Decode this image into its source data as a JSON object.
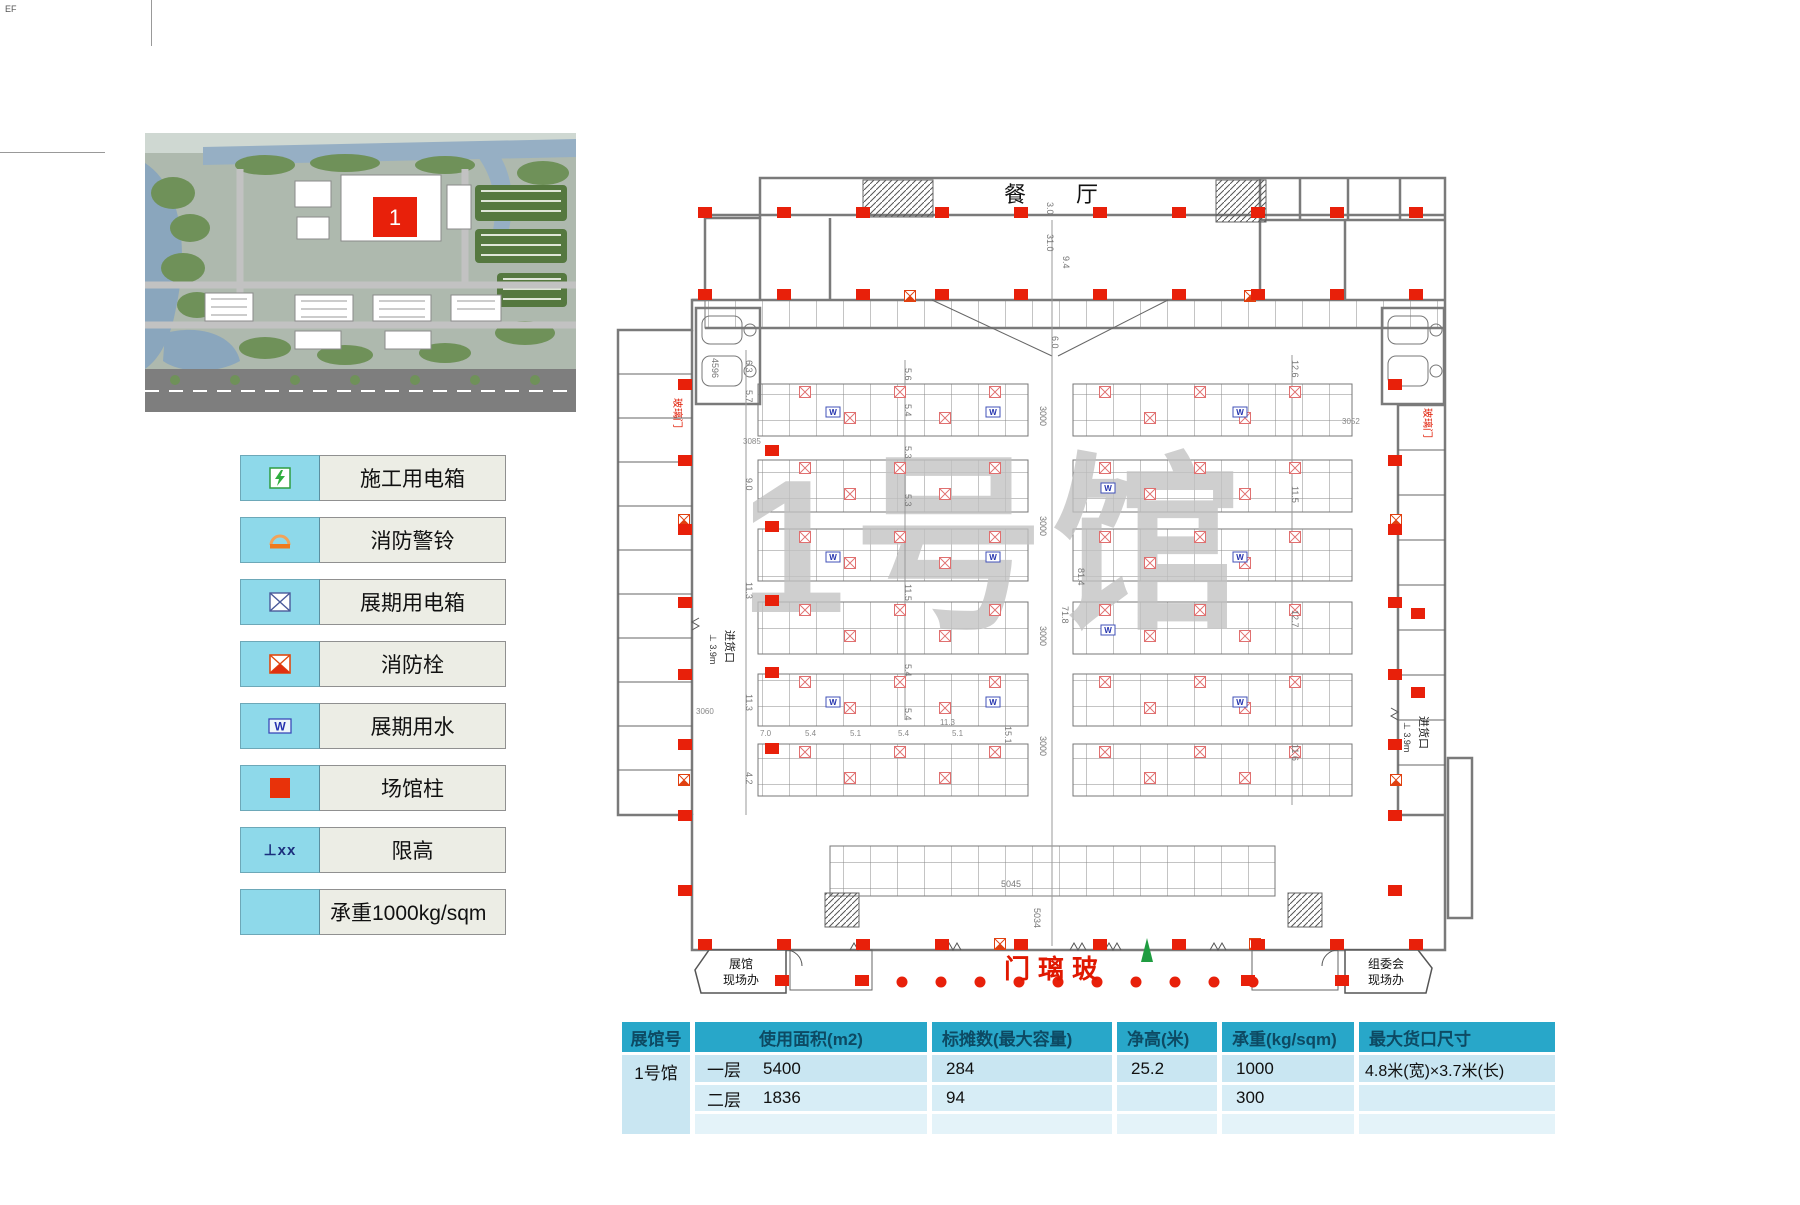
{
  "page": {
    "corner_mark": "EF"
  },
  "site_map": {
    "building_label": "1"
  },
  "legend": {
    "items": [
      {
        "name": "construction-power-box",
        "label": "施工用电箱"
      },
      {
        "name": "fire-alarm-bell",
        "label": "消防警铃"
      },
      {
        "name": "exhibition-power-box",
        "label": "展期用电箱"
      },
      {
        "name": "fire-hydrant",
        "label": "消防栓"
      },
      {
        "name": "exhibition-water",
        "label": "展期用水",
        "icon_text": "W"
      },
      {
        "name": "venue-column",
        "label": "场馆柱"
      },
      {
        "name": "height-limit",
        "label": "限高",
        "icon_text": "⊥xx"
      },
      {
        "name": "load-capacity",
        "label": "承重1000kg/sqm"
      }
    ]
  },
  "floor_plan": {
    "watermark": "1号馆",
    "restaurant_label": "餐　厅",
    "glass_door_bottom": "门璃玻",
    "glass_door_side": "玻璃门",
    "exhibition_office_line1": "展馆",
    "exhibition_office_line2": "现场办",
    "committee_office_line1": "组委会",
    "committee_office_line2": "现场办",
    "loading_dock_label": "进货口",
    "loading_height": "⊥ 3.9m",
    "water_symbol_letter": "W",
    "dims": {
      "d3_0": "3.0",
      "d31_0": "31.0",
      "d9_4": "9.4",
      "d6_0": "6.0",
      "d4596": "4596",
      "d3085": "3085",
      "d3052": "3052",
      "d3060": "3060",
      "d5045": "5045",
      "d5034": "5034",
      "d3000": "3000",
      "l1": "6.3",
      "l2": "5.7",
      "l3": "9.0",
      "l4": "11.3",
      "l5": "11.3",
      "l6": "4.2",
      "m1": "5.6",
      "m2": "5.4",
      "m3": "5.3",
      "m4": "5.3",
      "m5": "11.5",
      "m6": "5.4",
      "m7": "5.4",
      "r1": "12.6",
      "r2": "11.5",
      "r3": "12.7",
      "r4": "11.6",
      "c81": "81.4",
      "c71": "71.8",
      "c15": "15.1",
      "b1": "7.0",
      "b2": "5.4",
      "b3": "5.1",
      "b4": "5.4",
      "b5": "11.3",
      "b6": "5.1"
    }
  },
  "spec_table": {
    "headers": [
      "展馆号",
      "使用面积(m2)",
      "标摊数(最大容量)",
      "净高(米)",
      "承重(kg/sqm)",
      "最大货口尺寸"
    ],
    "hall_name": "1号馆",
    "rows": [
      {
        "floor": "一层",
        "area": "5400",
        "booths": "284",
        "clear_height": "25.2",
        "load": "1000",
        "gate_size": "4.8米(宽)×3.7米(长)"
      },
      {
        "floor": "二层",
        "area": "1836",
        "booths": "94",
        "clear_height": "",
        "load": "300",
        "gate_size": ""
      }
    ]
  }
}
